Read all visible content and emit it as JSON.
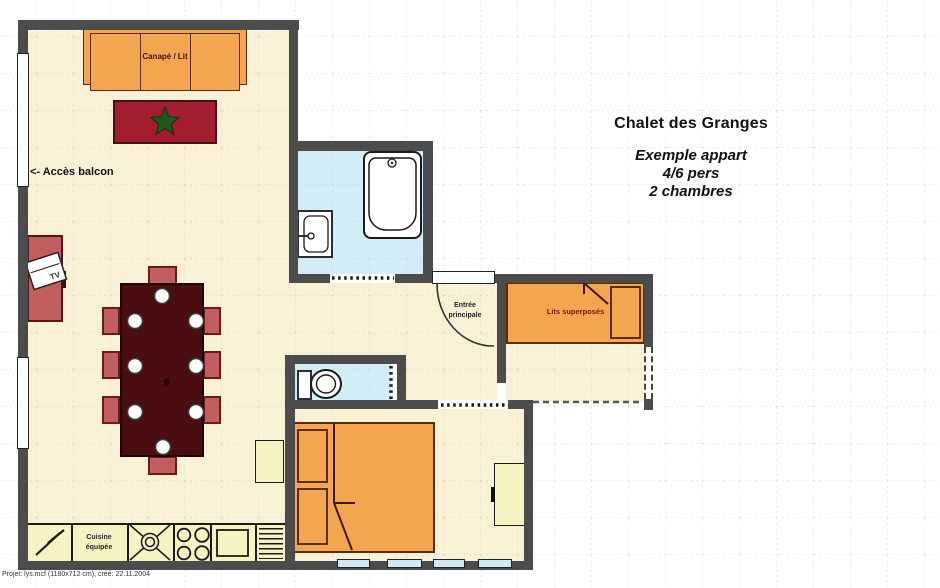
{
  "header": {
    "title": "Chalet des Granges",
    "subtitle_lines": [
      "Exemple appart",
      "4/6 pers",
      "2 chambres"
    ]
  },
  "labels": {
    "sofa": "Canapé / Lit",
    "balcony_access": "<- Accès balcon",
    "tv": "TV",
    "entrance_line1": "Entrée",
    "entrance_line2": "principale",
    "bunk_beds": "Lits superposés",
    "kitchen_line1": "Cuisine",
    "kitchen_line2": "équipée"
  },
  "footer": {
    "project_info": "Projet: lys.mcf (1180x712 cm), créé: 22.11.2004"
  },
  "colors": {
    "wall": "#4c4c4c",
    "floor": "#f8f1d5",
    "wet-floor": "#d3edf8",
    "furniture-orange": "#f4a54f",
    "furniture-orange-border": "#5a2d00",
    "rug-red": "#a31d31",
    "rug-border": "#45101b",
    "star-green": "#1d5c1d",
    "table-dark": "#4a0d10",
    "chair-red": "#c15e60",
    "chair-border": "#6e1a1c",
    "cabinet-yellow": "#f6f2c1",
    "window-blue": "#cfe9f5",
    "label-red": "#7a1400",
    "grid": "#b5b5b5"
  }
}
